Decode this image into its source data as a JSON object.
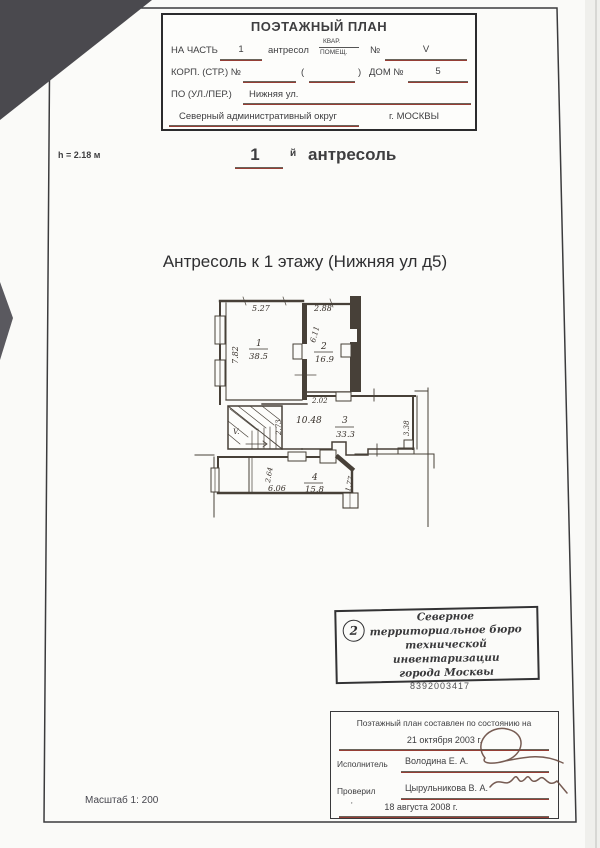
{
  "colors": {
    "ink": "#3e3e40",
    "plan_line": "#474038",
    "underline_teal": "#4f7d74",
    "underline_red": "#a03a30",
    "paper": "#fafaf8"
  },
  "header": {
    "title": "ПОЭТАЖНЫЙ ПЛАН",
    "na_chast_label": "НА ЧАСТЬ",
    "na_chast_value": "1",
    "type_value": "антресол",
    "kvar_label": "КВАР.",
    "pomesh_label": "ПОМЕЩ.",
    "num_label": "№",
    "num_value": "V",
    "korp_label": "КОРП. (СТР.) №",
    "paren_open": "(",
    "paren_close": ")",
    "dom_label": "ДОМ №",
    "dom_value": "5",
    "street_label": "ПО (УЛ./ПЕР.)",
    "street_value": "Нижняя ул.",
    "district": "Северный административный округ",
    "city": "г. МОСКВЫ"
  },
  "height_note": "h = 2.18 м",
  "floor_heading": {
    "number": "1",
    "suffix": "й",
    "word": "антресоль"
  },
  "subtitle": "Антресоль к 1 этажу (Нижняя ул д5)",
  "plan": {
    "rooms": [
      {
        "number": "1",
        "area": "38.5"
      },
      {
        "number": "2",
        "area": "16.9"
      },
      {
        "number": "3",
        "area": "33.3"
      },
      {
        "number": "4",
        "area": "15.8"
      }
    ],
    "stair_label": "V.",
    "dims": {
      "room1_width": "5.27",
      "room1_depth": "7.82",
      "room2_width": "2.88",
      "room2_depth": "6.11",
      "passage_width": "2.02",
      "corridor_length": "10.48",
      "stair_width": "2.73",
      "room3_depth": "3.38",
      "room4_closet_depth": "2.64",
      "room4_width": "6.06",
      "room4_right": "1.77"
    }
  },
  "stamp": {
    "number": "2",
    "line1": "Северное",
    "line2": "территориальное бюро",
    "line3": "технической инвентаризации",
    "line4": "города Москвы",
    "code": "8392003417"
  },
  "signoff": {
    "line1": "Поэтажный план составлен по состоянию на",
    "date1": "21 октября 2003 г.",
    "executor_label": "Исполнитель",
    "executor_name": "Володина Е. А.",
    "checker_label": "Проверил",
    "checker_name": "Цырульникова В. А.",
    "date2": "18 августа 2008 г."
  },
  "scale_label": "Масштаб 1: 200"
}
